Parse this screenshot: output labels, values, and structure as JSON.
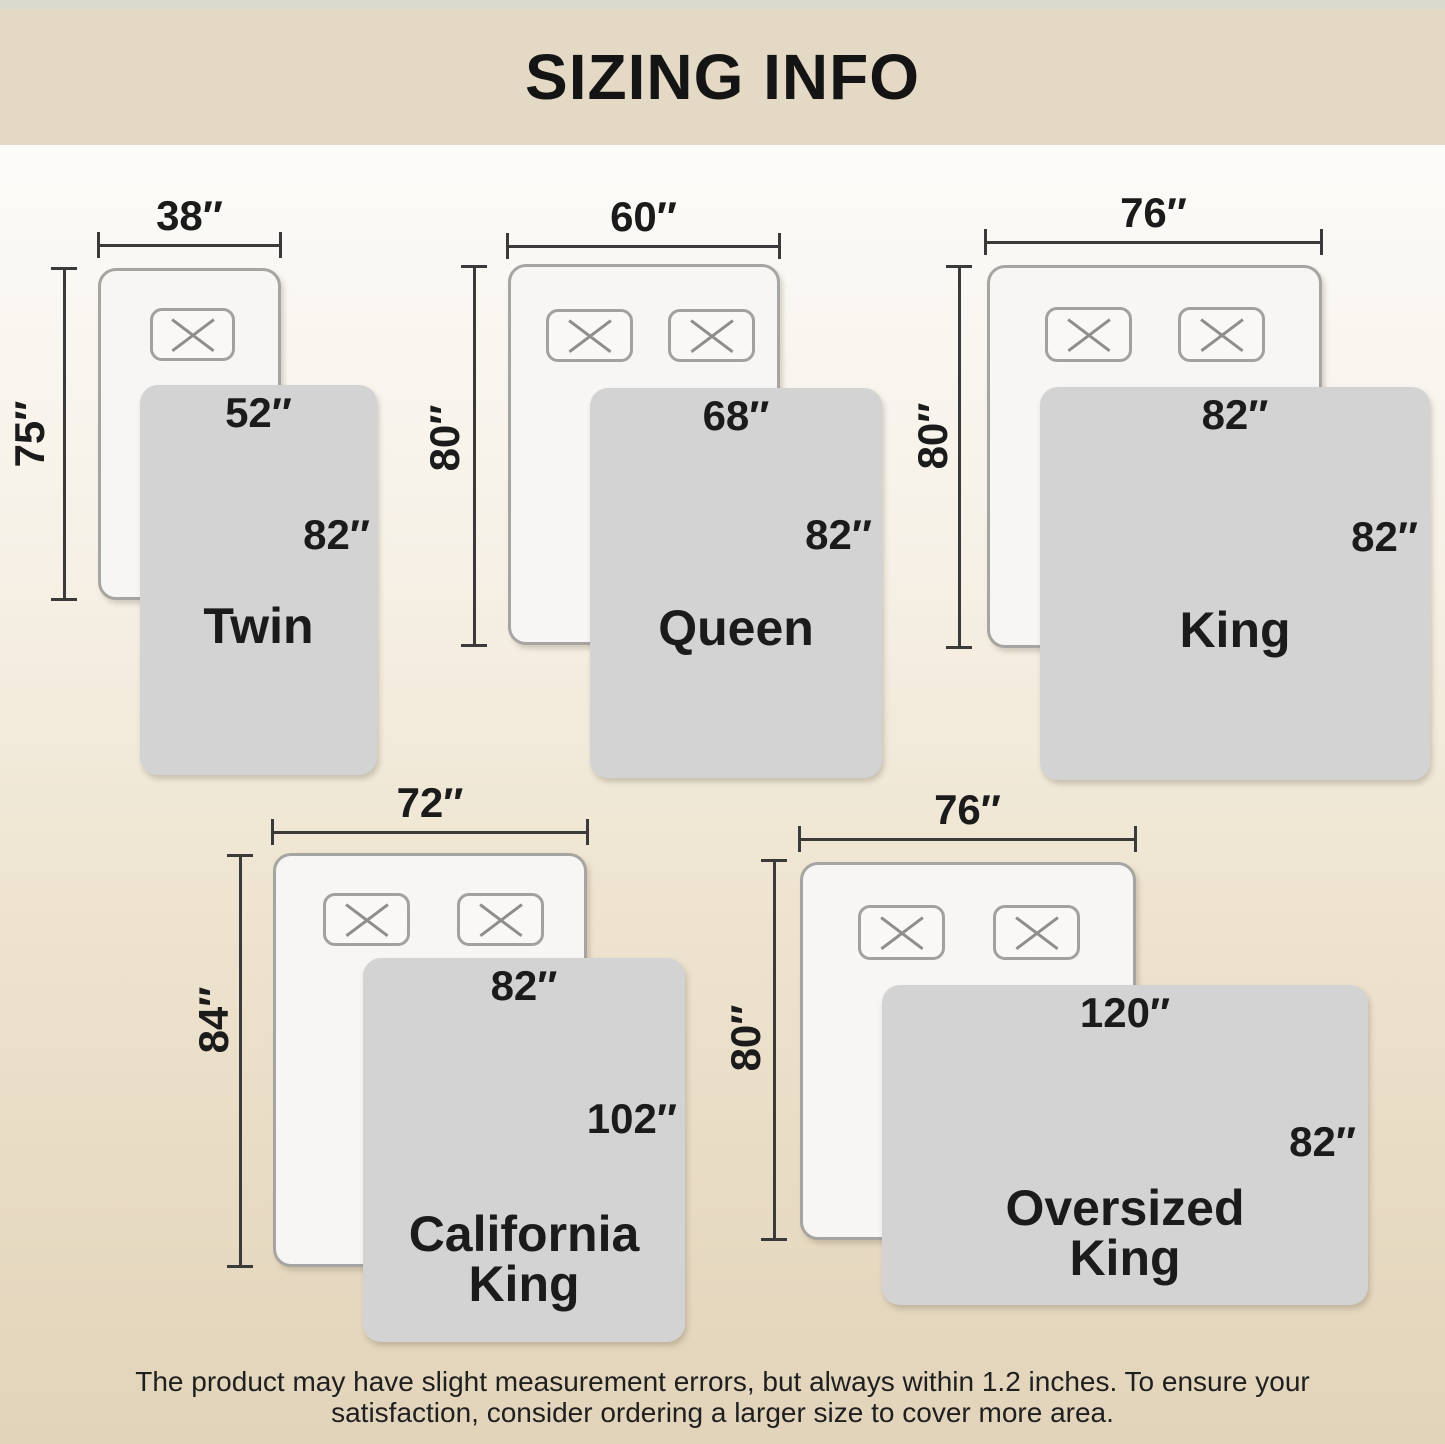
{
  "title": "SIZING INFO",
  "colors": {
    "header_band": "#e4d9c4",
    "background_top": "#fcfbf9",
    "background_bottom": "#e2d4ba",
    "blanket": "#d3d3d4",
    "bed_fill": "#f7f6f4",
    "line": "#3a3a3a",
    "text": "#1a1a1a"
  },
  "icons": {
    "pillow_marker": "x-mark"
  },
  "beds": [
    {
      "id": "twin",
      "name_lines": [
        "Twin"
      ],
      "bed_width": "38″",
      "bed_length": "75″",
      "blanket_width": "52″",
      "blanket_length": "82″",
      "pillow_count": 1
    },
    {
      "id": "queen",
      "name_lines": [
        "Queen"
      ],
      "bed_width": "60″",
      "bed_length": "80″",
      "blanket_width": "68″",
      "blanket_length": "82″",
      "pillow_count": 2
    },
    {
      "id": "king",
      "name_lines": [
        "King"
      ],
      "bed_width": "76″",
      "bed_length": "80″",
      "blanket_width": "82″",
      "blanket_length": "82″",
      "pillow_count": 2
    },
    {
      "id": "california-king",
      "name_lines": [
        "California",
        "King"
      ],
      "bed_width": "72″",
      "bed_length": "84″",
      "blanket_width": "82″",
      "blanket_length": "102″",
      "pillow_count": 2
    },
    {
      "id": "oversized-king",
      "name_lines": [
        "Oversized",
        "King"
      ],
      "bed_width": "76″",
      "bed_length": "80″",
      "blanket_width": "120″",
      "blanket_length": "82″",
      "pillow_count": 2
    }
  ],
  "footer": {
    "line1": "The product may have slight measurement errors, but always within 1.2 inches. To ensure your",
    "line2": "satisfaction, consider ordering a larger size to cover more area."
  }
}
